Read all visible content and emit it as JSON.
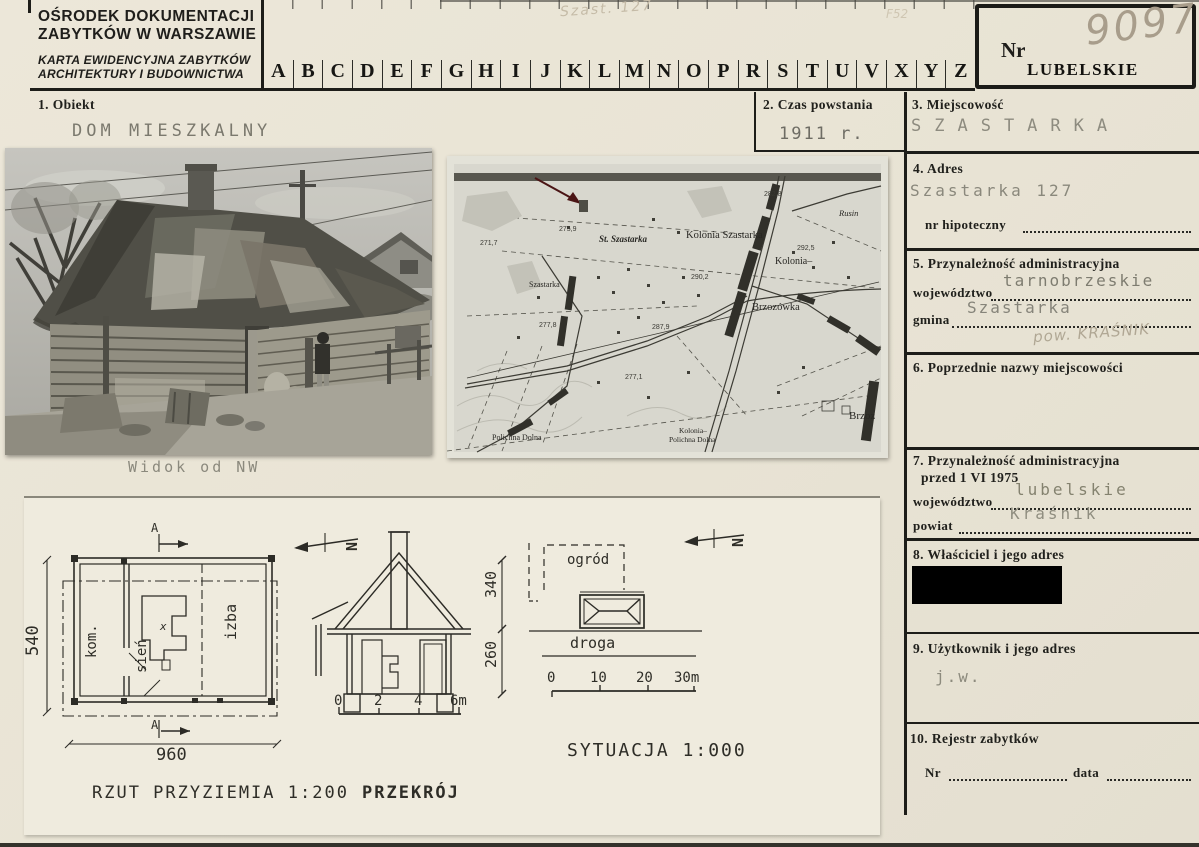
{
  "colors": {
    "paper": "#e9e4d5",
    "ink": "#1d1d19",
    "typed_text": "#75736a",
    "pencil": "#b0a794",
    "redaction": "#000000",
    "map_arrow": "#4a1414"
  },
  "header": {
    "org_line1": "OŚRODEK DOKUMENTACJI",
    "org_line2": "ZABYTKÓW W WARSZAWIE",
    "card_line1": "KARTA EWIDENCYJNA ZABYTKÓW",
    "card_line2": "ARCHITEKTURY I BUDOWNICTWA",
    "letters": [
      "A",
      "B",
      "C",
      "D",
      "E",
      "F",
      "G",
      "H",
      "I",
      "J",
      "K",
      "L",
      "M",
      "N",
      "O",
      "P",
      "R",
      "S",
      "T",
      "U",
      "V",
      "X",
      "Y",
      "Z"
    ],
    "nr_label": "Nr",
    "voivodeship_stamp": "LUBELSKIE",
    "handwritten_number": "9097",
    "pencil_note_top": "Szast. 127",
    "pencil_note_f": "F52"
  },
  "sections": {
    "s1": {
      "label": "1. Obiekt",
      "value": "DOM MIESZKALNY"
    },
    "s2": {
      "label": "2. Czas powstania",
      "value": "1911 r."
    },
    "s3": {
      "label": "3. Miejscowość",
      "value": "SZASTARKA"
    },
    "s4": {
      "label": "4. Adres",
      "value": "Szastarka 127",
      "hyp_label": "nr hipoteczny"
    },
    "s5": {
      "label": "5. Przynależność administracyjna",
      "woj_label": "województwo",
      "woj_value": "tarnobrzeskie",
      "gmina_label": "gmina",
      "gmina_value": "Szastarka",
      "pencil_note": "pow. KRAŚNIK"
    },
    "s6": {
      "label": "6. Poprzednie nazwy miejscowości"
    },
    "s7": {
      "label": "7. Przynależność administracyjna",
      "label2": "przed 1 VI 1975",
      "woj_label": "województwo",
      "woj_value": "lubelskie",
      "powiat_label": "powiat",
      "powiat_value": "Kraśnik"
    },
    "s8": {
      "label": "8. Właściciel i jego adres"
    },
    "s9": {
      "label": "9. Użytkownik i jego adres",
      "value": "j.w."
    },
    "s10": {
      "label": "10. Rejestr zabytków",
      "nr_label": "Nr",
      "data_label": "data"
    }
  },
  "photo": {
    "caption": "Widok od NW"
  },
  "map": {
    "labels": {
      "st_szastarka": "St. Szastarka",
      "kolonia_szastarka": "Kolonia Szastarka",
      "kolonia": "Kolonia–",
      "rusin": "Rusin",
      "brzozowka": "Brzozówka",
      "brzoz": "Brzoz",
      "polichna_dolna": "Polichna Dolna",
      "kolonia_polichna_1": "Kolonia–",
      "kolonia_polichna_2": "Polichna Dolna",
      "szastarka": "Szastarka"
    },
    "elevations": [
      "282,8",
      "275,9",
      "271,7",
      "290,2",
      "292,5",
      "287,9",
      "277,1",
      "277,8"
    ]
  },
  "drawings": {
    "plan_caption": "RZUT PRZYZIEMIA 1:200",
    "section_caption": "PRZEKRÓJ",
    "situation_caption": "SYTUACJA 1:000",
    "room_kom": "kom.",
    "room_sien": "sień",
    "room_izba": "izba",
    "garden": "ogród",
    "road": "droga",
    "stove_mark": "x",
    "section_mark_top": "A",
    "section_mark_bottom": "A",
    "north_mark": "N",
    "dim_width": "960",
    "dim_depth": "540",
    "dim_wall": "260",
    "dim_roof": "340",
    "scale_section": [
      "0",
      "2",
      "4",
      "6m"
    ],
    "scale_situation": [
      "0",
      "10",
      "20",
      "30m"
    ]
  }
}
